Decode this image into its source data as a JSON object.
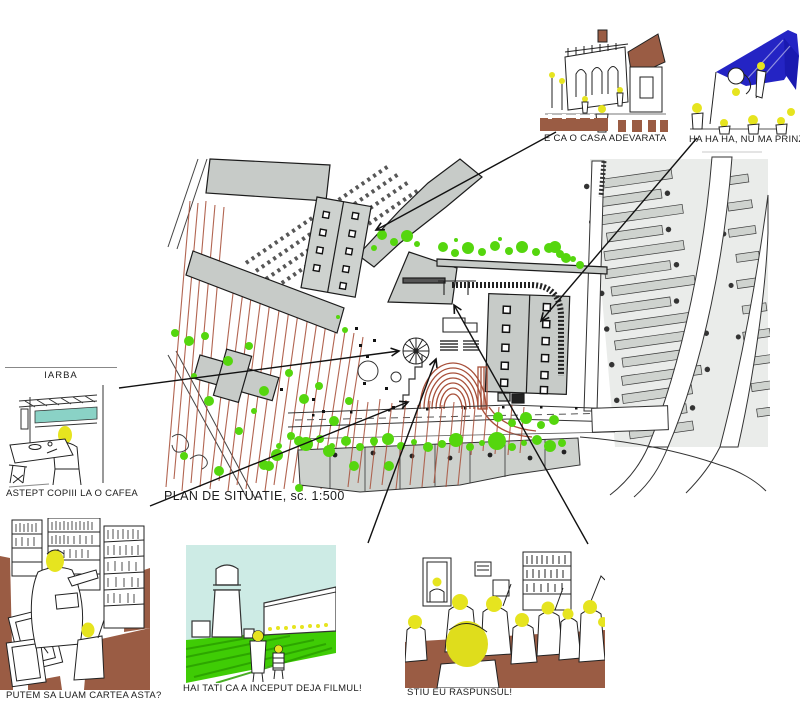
{
  "plan": {
    "caption": "PLAN DE SITUATIE, sc. 1:500"
  },
  "vignettes": [
    {
      "id": "casa-adevarata",
      "caption": "E CA O CASA ADEVARATA"
    },
    {
      "id": "nu-ma-prinzi",
      "caption": "HA HA HA, NU MA PRINZI!!"
    },
    {
      "id": "iarba-cafea",
      "label": "IARBA",
      "caption": "ASTEPT COPIII LA O CAFEA"
    },
    {
      "id": "cartea-asta",
      "caption": "PUTEM SA LUAM CARTEA ASTA?"
    },
    {
      "id": "filmul",
      "caption": "HAI TATI CA A INCEPUT DEJA FILMUL!"
    },
    {
      "id": "raspunsul",
      "caption": "STIU EU RASPUNSUL!"
    }
  ],
  "colors": {
    "tree_green": "#55d60e",
    "lawn_green": "#3fcc05",
    "sky_cyan": "#cdebe5",
    "window_teal": "#8ad2c6",
    "head_yellow": "#e6e41f",
    "floor_brown": "#9a5c44",
    "canopy_blue": "#2424c4",
    "plan_red": "#a8503a",
    "building_gray": "#c7cbc8"
  }
}
